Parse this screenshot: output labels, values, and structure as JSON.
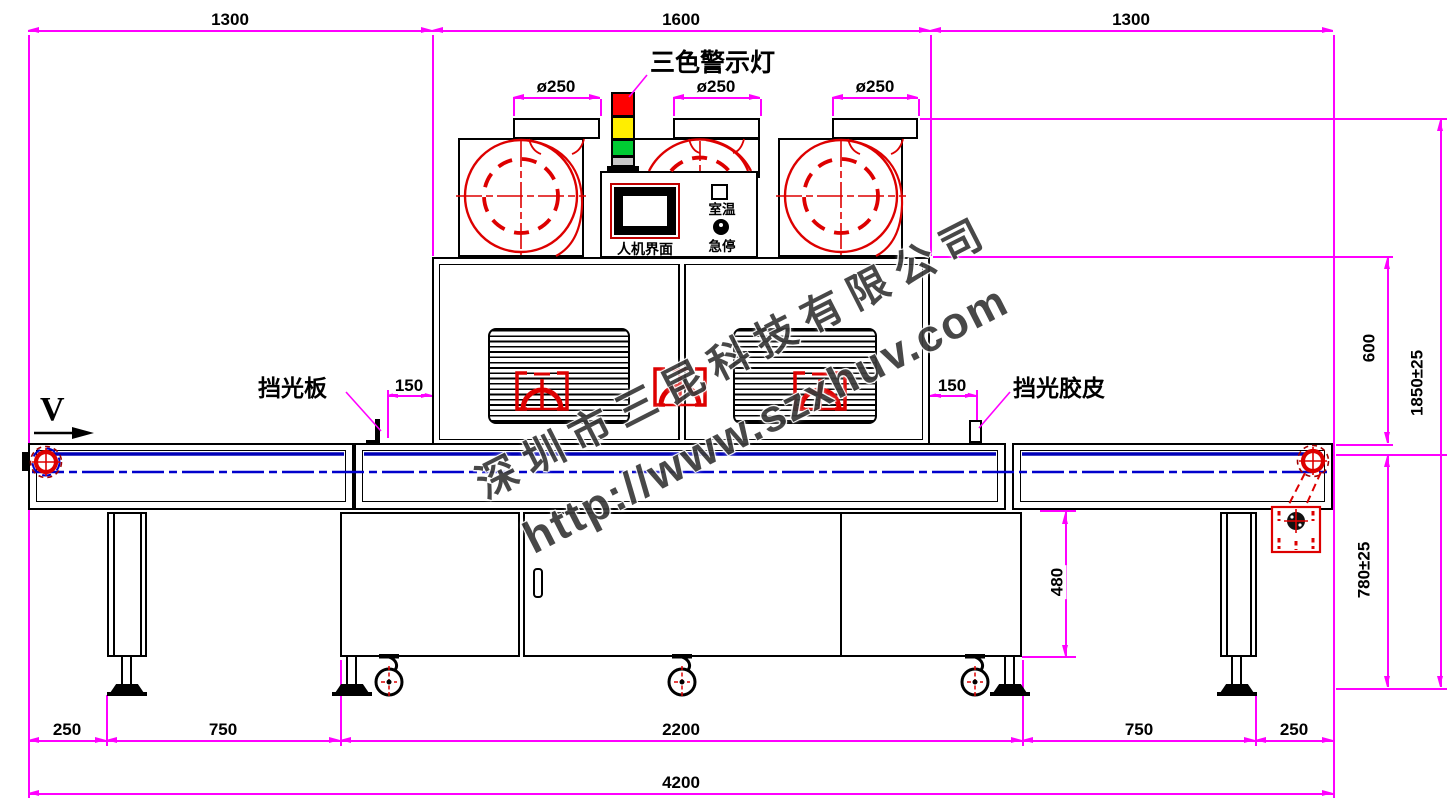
{
  "drawing_type": "UV curing conveyor machine - front elevation",
  "dims": {
    "top_left": "1300",
    "top_mid": "1600",
    "top_right": "1300",
    "flange_left": "ø250",
    "flange_mid": "ø250",
    "flange_right": "ø250",
    "chamber_height": "600",
    "total_height": "1850±25",
    "belt_height": "780±25",
    "plate_offset_left": "150",
    "plate_offset_right": "150",
    "cabinet_height": "480",
    "bottom_1": "250",
    "bottom_2": "750",
    "bottom_3": "2200",
    "bottom_4": "750",
    "bottom_5": "250",
    "total_length": "4200"
  },
  "labels": {
    "tower_light": "三色警示灯",
    "shade_plate": "挡光板",
    "shade_rubber": "挡光胶皮",
    "hmi": "人机界面",
    "room_temp": "室温",
    "emergency_stop": "急停",
    "belt_direction": "V"
  },
  "watermark": {
    "company": "深圳市三昆科技有限公司",
    "url": "http://www.szxhuv.com"
  },
  "colors": {
    "dimension": "#FF00FF",
    "outline": "#000000",
    "machine_red": "#DD0000",
    "belt_blue": "#0000C0",
    "tower_red": "#FF0000",
    "tower_yellow": "#FFEE00",
    "tower_green": "#00CC33",
    "tower_gray": "#C8C8C8"
  }
}
